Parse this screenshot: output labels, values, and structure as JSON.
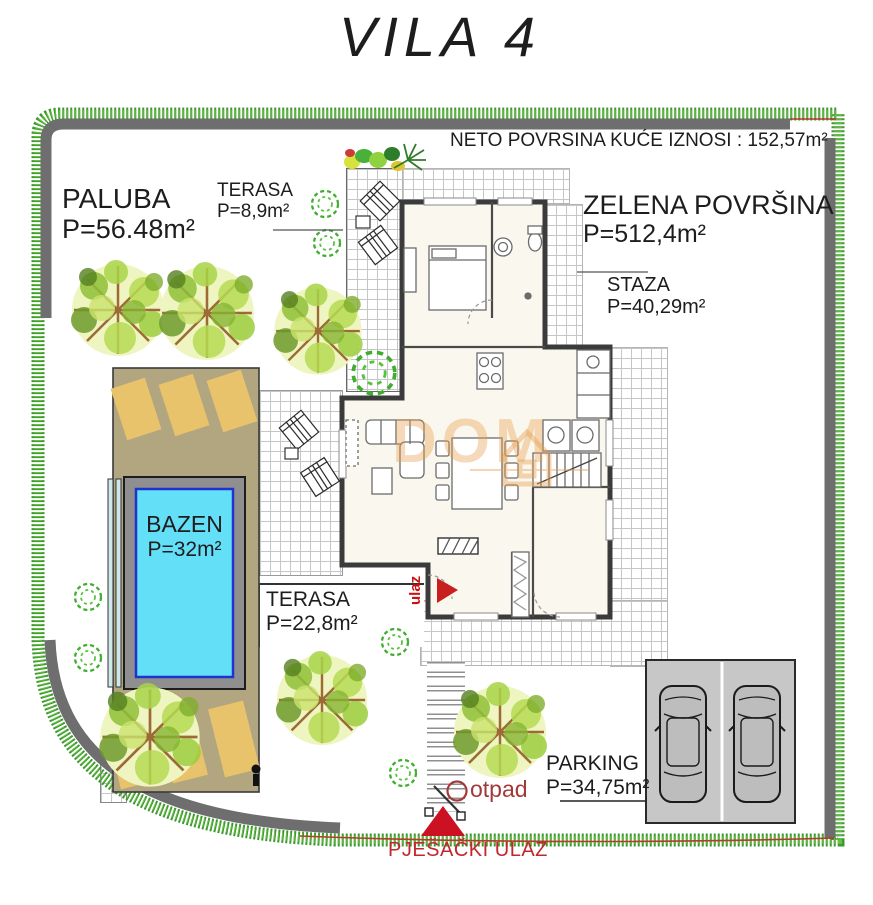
{
  "title": "VILA 4",
  "note": {
    "house_net_area": "NETO POVRSINA KUĆE IZNOSI : 152,57m²"
  },
  "areas": {
    "paluba": {
      "name": "PALUBA",
      "area": "P=56.48m²"
    },
    "terasa_top": {
      "name": "TERASA",
      "area": "P=8,9m²"
    },
    "zelena": {
      "name": "ZELENA  POVRŠINA",
      "area": "P=512,4m²"
    },
    "staza": {
      "name": "STAZA",
      "area": "P=40,29m²"
    },
    "bazen": {
      "name": "BAZEN",
      "area": "P=32m²"
    },
    "terasa_bottom": {
      "name": "TERASA",
      "area": "P=22,8m²"
    },
    "parking": {
      "name": "PARKING",
      "area": "P=34,75m²"
    }
  },
  "annotations": {
    "entrance": "ulaz",
    "waste": "otpad",
    "pedestrian_entrance": "PJEŠAČKI ULAZ"
  },
  "watermark": {
    "text": "DOM"
  },
  "colors": {
    "boundary_gray": "#6e6e6e",
    "hedge_green": "#3c9a2e",
    "deck_tan": "#b2a681",
    "lounger_tan": "#e9c36c",
    "pool_water_cyan": "#63e0f8",
    "pool_rim_blue": "#2233cc",
    "parking_gray": "#c7c7c7",
    "annotation_red": "#c1272d",
    "watermark_orange": "#e89e4e"
  }
}
